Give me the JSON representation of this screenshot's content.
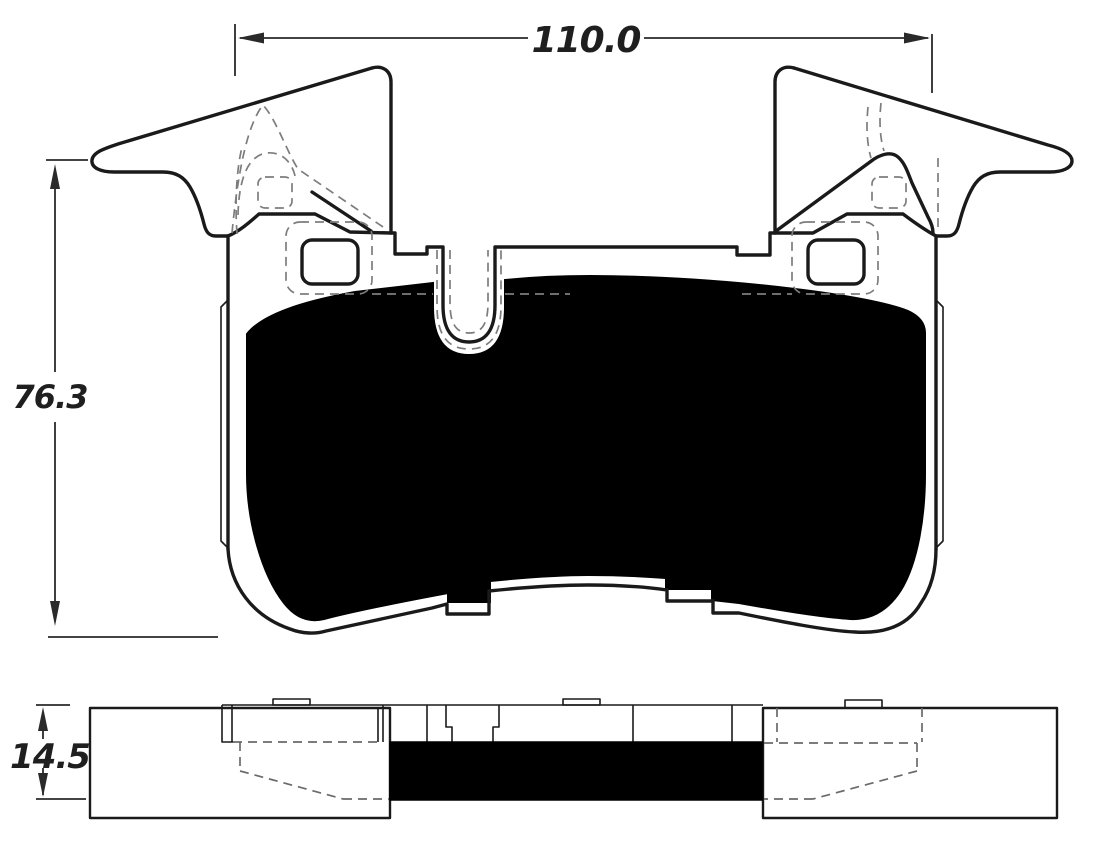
{
  "drawing": {
    "title": "brake-pad-technical-drawing",
    "colors": {
      "line": "#1a1a1a",
      "hidden_line": "#7d7d7d",
      "friction_fill": "#000000",
      "background": "#ffffff"
    },
    "dimensions": {
      "width": {
        "value": "110.0"
      },
      "height": {
        "value": "76.3"
      },
      "thickness": {
        "value": "14.5"
      }
    }
  }
}
